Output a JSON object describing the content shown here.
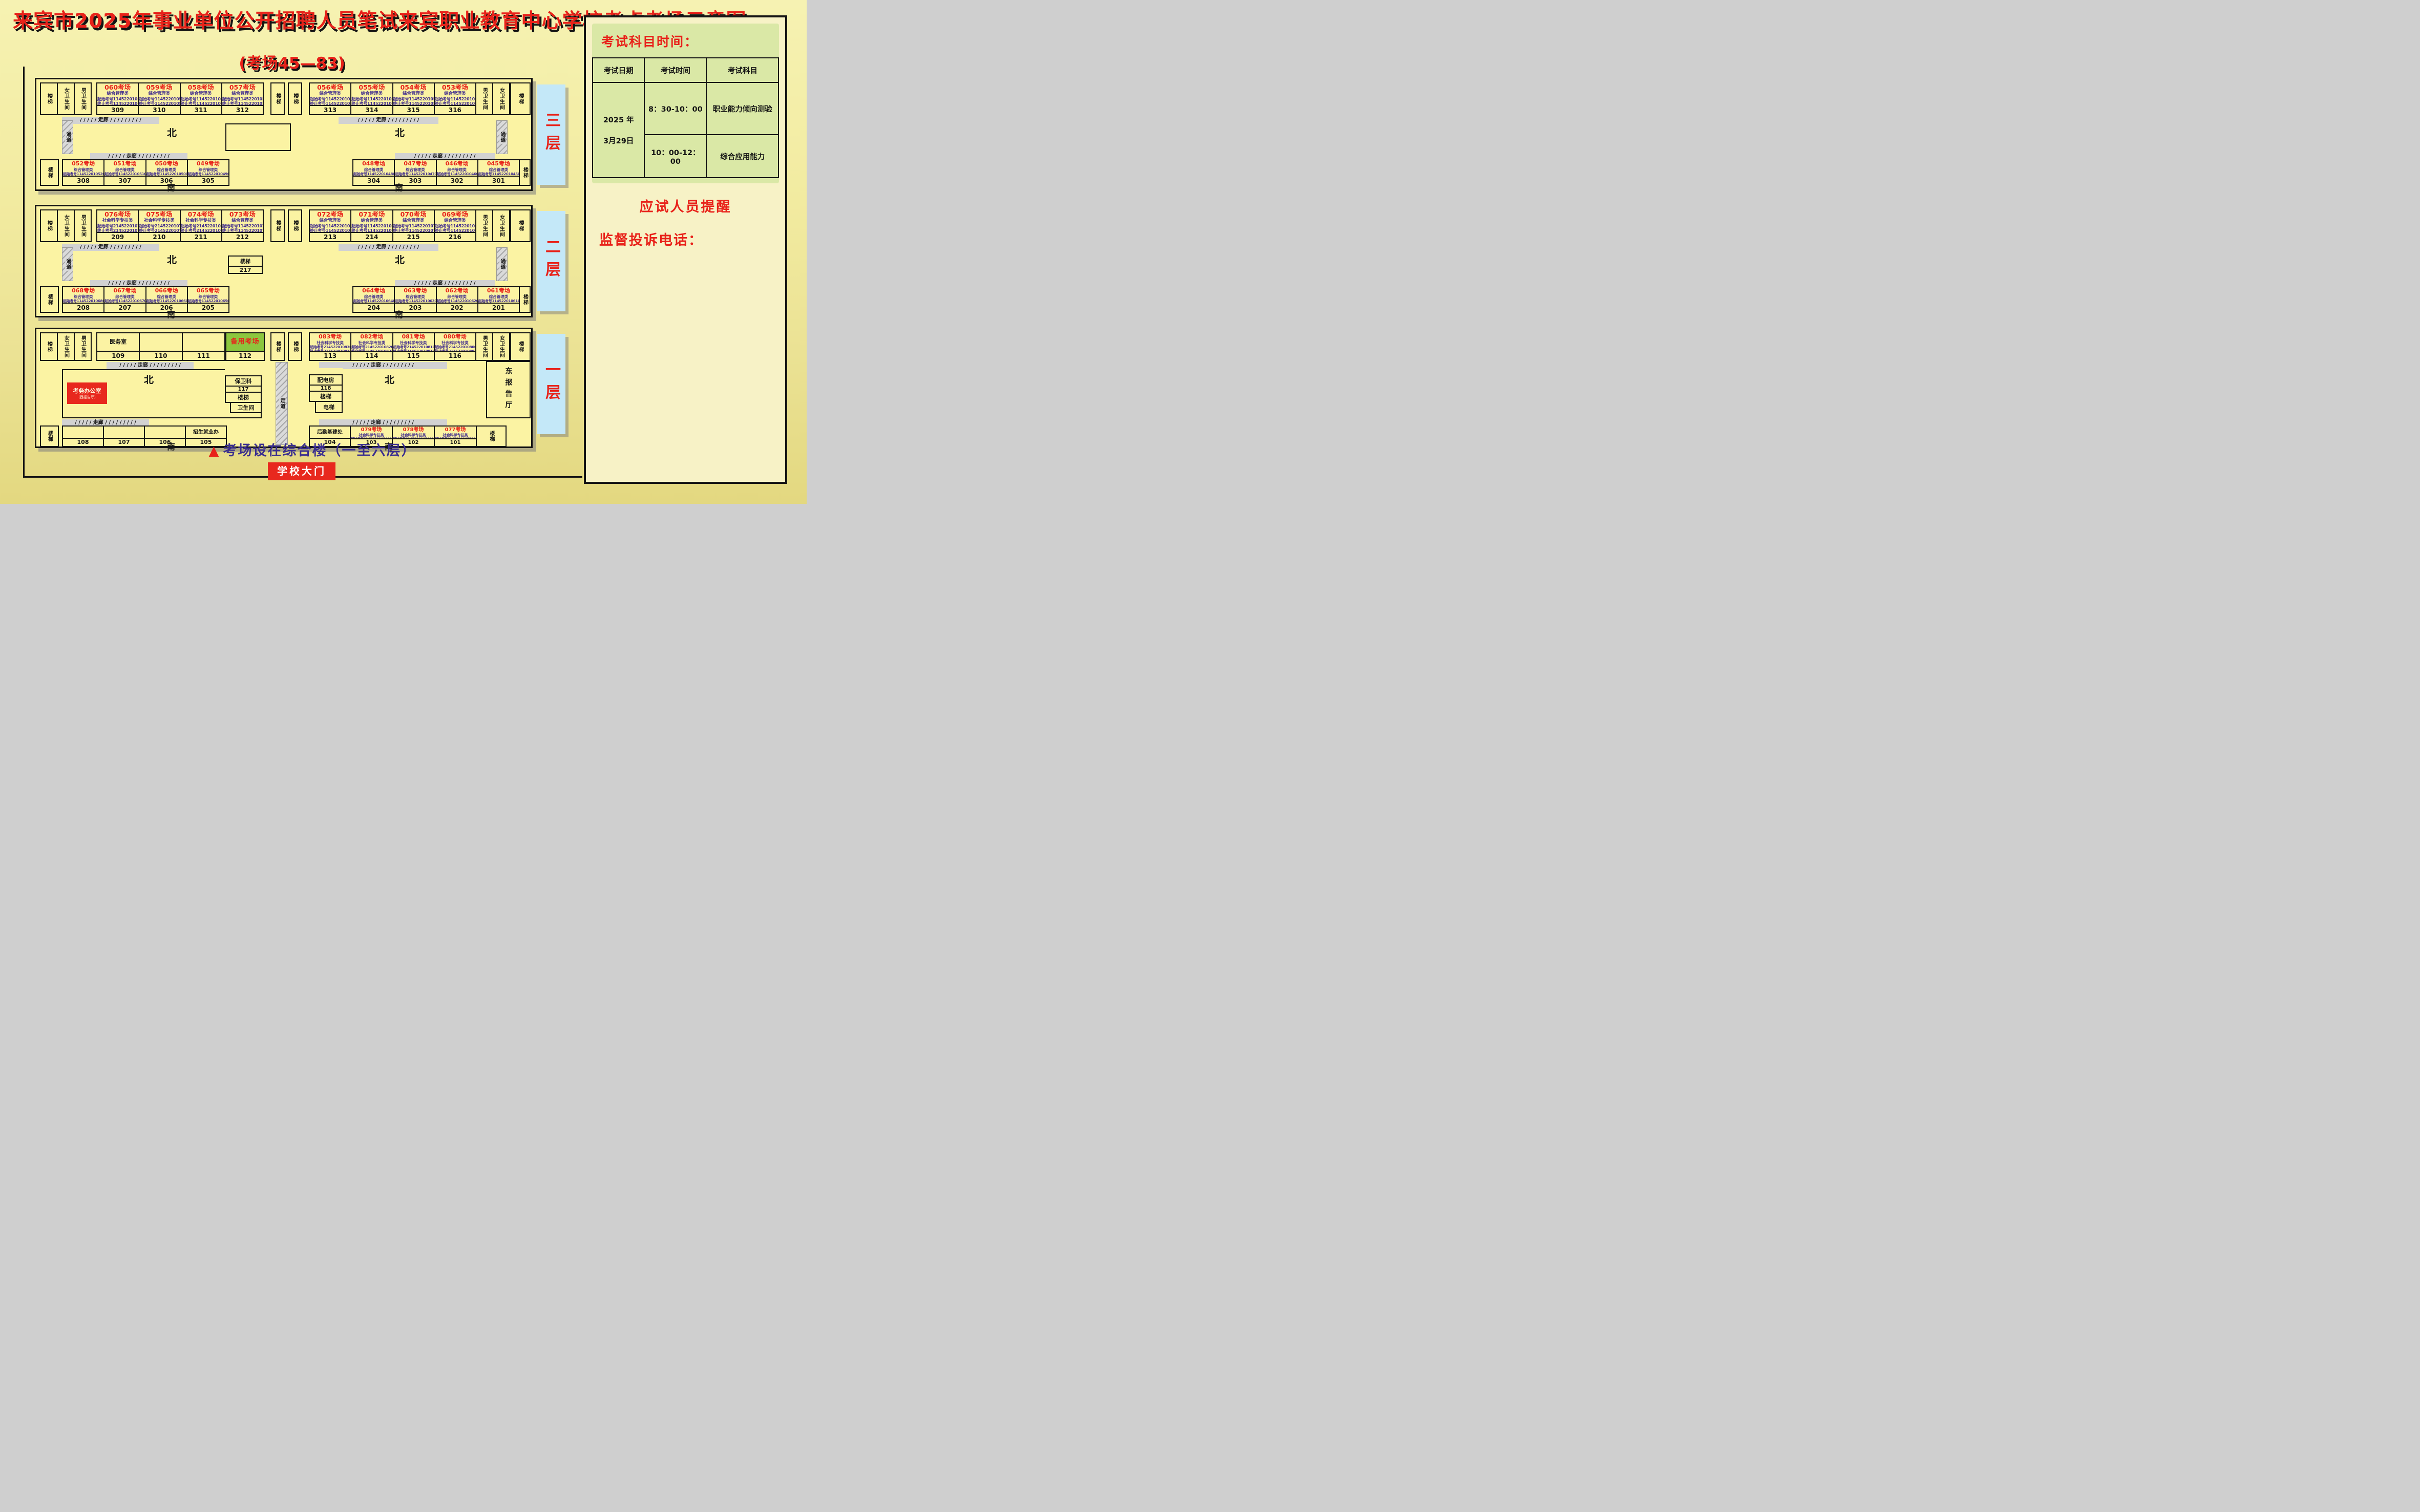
{
  "title": "来宾市2025年事业单位公开招聘人员笔试来宾职业教育中心学校考点考场示意图",
  "subtitle": "(考场45—83)",
  "labels": {
    "stairs": "楼梯",
    "toilet_f": "女卫生间",
    "toilet_m": "男卫生间",
    "corridor": "/ / / / / 走廊 / / / / / / / / /",
    "passage": "通道",
    "walkway": "走道",
    "north": "北",
    "south": "南"
  },
  "floor3": {
    "tab": "三层",
    "north_left": [
      {
        "t": "060考场",
        "c": "综合管理类",
        "s": "起始考号1145220106001",
        "e": "终止考号1145220106030",
        "n": "309"
      },
      {
        "t": "059考场",
        "c": "综合管理类",
        "s": "起始考号1145220105901",
        "e": "终止考号1145220105930",
        "n": "310"
      },
      {
        "t": "058考场",
        "c": "综合管理类",
        "s": "起始考号1145220105801",
        "e": "终止考号1145220105830",
        "n": "311"
      },
      {
        "t": "057考场",
        "c": "综合管理类",
        "s": "起始考号1145220105701",
        "e": "终止考号1145220105730",
        "n": "312"
      }
    ],
    "north_right": [
      {
        "t": "056考场",
        "c": "综合管理类",
        "s": "起始考号1145220105601",
        "e": "终止考号1145220105630",
        "n": "313"
      },
      {
        "t": "055考场",
        "c": "综合管理类",
        "s": "起始考号1145220105501",
        "e": "终止考号1145220105530",
        "n": "314"
      },
      {
        "t": "054考场",
        "c": "综合管理类",
        "s": "起始考号1145220105401",
        "e": "终止考号1145220105430",
        "n": "315"
      },
      {
        "t": "053考场",
        "c": "综合管理类",
        "s": "起始考号1145220105301",
        "e": "终止考号1145220105330",
        "n": "316"
      }
    ],
    "south_left": [
      {
        "t": "052考场",
        "c": "综合管理类",
        "s": "起始考号1145220105201",
        "e": "终止考号1145220105230",
        "n": "308"
      },
      {
        "t": "051考场",
        "c": "综合管理类",
        "s": "起始考号1145220105101",
        "e": "终止考号1145220105130",
        "n": "307"
      },
      {
        "t": "050考场",
        "c": "综合管理类",
        "s": "起始考号1145220105001",
        "e": "终止考号1145220105030",
        "n": "306"
      },
      {
        "t": "049考场",
        "c": "综合管理类",
        "s": "起始考号1145220104901",
        "e": "终止考号1145220104930",
        "n": "305"
      }
    ],
    "south_right": [
      {
        "t": "048考场",
        "c": "综合管理类",
        "s": "起始考号1145220104801",
        "e": "终止考号1145220104830",
        "n": "304"
      },
      {
        "t": "047考场",
        "c": "综合管理类",
        "s": "起始考号1145220104701",
        "e": "终止考号1145220104730",
        "n": "303"
      },
      {
        "t": "046考场",
        "c": "综合管理类",
        "s": "起始考号1145220104601",
        "e": "终止考号1145220104630",
        "n": "302"
      },
      {
        "t": "045考场",
        "c": "综合管理类",
        "s": "起始考号1145220104501",
        "e": "终止考号1145220104530",
        "n": "301"
      }
    ]
  },
  "floor2": {
    "tab": "二层",
    "center_stairs": {
      "label": "楼梯",
      "n": "217"
    },
    "north_left": [
      {
        "t": "076考场",
        "c": "社会科学专技类",
        "s": "起始考号2145220107601",
        "e": "终止考号2145220107630",
        "n": "209"
      },
      {
        "t": "075考场",
        "c": "社会科学专技类",
        "s": "起始考号2145220107501",
        "e": "终止考号2145220107530",
        "n": "210"
      },
      {
        "t": "074考场",
        "c": "社会科学专技类",
        "s": "起始考号2145220107401",
        "e": "终止考号2145220107430",
        "n": "211"
      },
      {
        "t": "073考场",
        "c": "综合管理类",
        "s": "起始考号1145220107301",
        "e": "终止考号1145220107309",
        "n": "212"
      }
    ],
    "north_right": [
      {
        "t": "072考场",
        "c": "综合管理类",
        "s": "起始考号1145220107201",
        "e": "终止考号1145220107230",
        "n": "213"
      },
      {
        "t": "071考场",
        "c": "综合管理类",
        "s": "起始考号1145220107101",
        "e": "终止考号1145220107130",
        "n": "214"
      },
      {
        "t": "070考场",
        "c": "综合管理类",
        "s": "起始考号1145220107001",
        "e": "终止考号1145220107030",
        "n": "215"
      },
      {
        "t": "069考场",
        "c": "综合管理类",
        "s": "起始考号1145220106901",
        "e": "终止考号1145220106930",
        "n": "216"
      }
    ],
    "south_left": [
      {
        "t": "068考场",
        "c": "综合管理类",
        "s": "起始考号1145220106801",
        "e": "终止考号1145220106830",
        "n": "208"
      },
      {
        "t": "067考场",
        "c": "综合管理类",
        "s": "起始考号1145220106701",
        "e": "终止考号1145220106730",
        "n": "207"
      },
      {
        "t": "066考场",
        "c": "综合管理类",
        "s": "起始考号1145220106601",
        "e": "终止考号1145220106630",
        "n": "206"
      },
      {
        "t": "065考场",
        "c": "综合管理类",
        "s": "起始考号1145220106501",
        "e": "终止考号1145220106530",
        "n": "205"
      }
    ],
    "south_right": [
      {
        "t": "064考场",
        "c": "综合管理类",
        "s": "起始考号1145220106401",
        "e": "终止考号1145220106430",
        "n": "204"
      },
      {
        "t": "063考场",
        "c": "综合管理类",
        "s": "起始考号1145220106301",
        "e": "终止考号1145220106330",
        "n": "203"
      },
      {
        "t": "062考场",
        "c": "综合管理类",
        "s": "起始考号1145220106201",
        "e": "终止考号1145220106230",
        "n": "202"
      },
      {
        "t": "061考场",
        "c": "综合管理类",
        "s": "起始考号1145220106101",
        "e": "终止考号1145220106130",
        "n": "201"
      }
    ]
  },
  "floor1": {
    "tab": "一层",
    "north_plain": [
      {
        "label": "医务室",
        "n": "109"
      },
      {
        "label": "",
        "n": "110"
      },
      {
        "label": "",
        "n": "111"
      }
    ],
    "backup": {
      "label": "备用考场",
      "n": "112"
    },
    "north_right": [
      {
        "t": "083考场",
        "c": "社会科学专技类",
        "s": "起始考号2145220108301",
        "e": "终止考号2145220108330",
        "n": "113"
      },
      {
        "t": "082考场",
        "c": "社会科学专技类",
        "s": "起始考号2145220108201",
        "e": "终止考号2145220108230",
        "n": "114"
      },
      {
        "t": "081考场",
        "c": "社会科学专技类",
        "s": "起始考号2145220108101",
        "e": "终止考号2145220108130",
        "n": "115"
      },
      {
        "t": "080考场",
        "c": "社会科学专技类",
        "s": "起始考号2145220108001",
        "e": "终止考号2145220108030",
        "n": "116"
      }
    ],
    "exam_office": {
      "line1": "考务办公室",
      "line2": "(西报告厅)"
    },
    "security_col": {
      "room": "保卫科",
      "n": "117",
      "stairs": "楼梯",
      "wc": "卫生间"
    },
    "power_col": {
      "room": "配电房",
      "n": "118",
      "stairs": "楼梯",
      "lift": "电梯"
    },
    "east_hall": "东报告厅",
    "south_plain": [
      {
        "label": "",
        "n": "108"
      },
      {
        "label": "",
        "n": "107"
      },
      {
        "label": "",
        "n": "106"
      },
      {
        "label": "招生就业办",
        "n": "105"
      }
    ],
    "logistics": {
      "label": "后勤基建处",
      "n": "104"
    },
    "south_right": [
      {
        "t": "079考场",
        "c": "社会科学专技类",
        "s": "起始考号2145220107901",
        "e": "终止考号2145220107930",
        "n": "103"
      },
      {
        "t": "078考场",
        "c": "社会科学专技类",
        "s": "起始考号2145220107801",
        "e": "终止考号2145220107830",
        "n": "102"
      },
      {
        "t": "077考场",
        "c": "社会科学专技类",
        "s": "起始考号2145220107701",
        "e": "终止考号2145220107730",
        "n": "101"
      }
    ]
  },
  "sidebar": {
    "schedule_title": "考试科目时间：",
    "table": {
      "h_date": "考试日期",
      "h_time": "考试时间",
      "h_subject": "考试科目",
      "date_l1": "2025 年",
      "date_l2": "3月29日",
      "r1_time": "8：30-10：00",
      "r1_subject": "职业能力倾向测验",
      "r2_time": "10：00-12：00",
      "r2_subject": "综合应用能力"
    },
    "notice_title": "应试人员提醒",
    "notice_paras": [
      "根据考试违规违纪行为处理规定，提醒各位应试人员：",
      "严禁将手机、智能手表、智能手环、蓝牙耳机等规定以外的电子用品带至座位。",
      "不得在考试开始信号发出前答题，或在考试结束信号发出后继续答题。",
      "上述内容已经履行法定提醒义务，在考试中如有违反，给予其所涉科目（场次）考试成绩为零分的处理。"
    ],
    "hotline_title": "监督投诉电话：",
    "phones": [
      "0772-4278510",
      "0772-4271588"
    ]
  },
  "bottom": {
    "triangle": "▲",
    "note": "考场设在综合楼（一至六层）",
    "gate": "学校大门"
  },
  "colors": {
    "accent_red": "#E8221A",
    "exam_no_purple": "#3F2B8E",
    "building_fill": "#FBF3A3",
    "floor_tab_blue": "#C4E8F8",
    "backup_green": "#8CC63E",
    "sidebar_green": "#DAE8A6"
  }
}
